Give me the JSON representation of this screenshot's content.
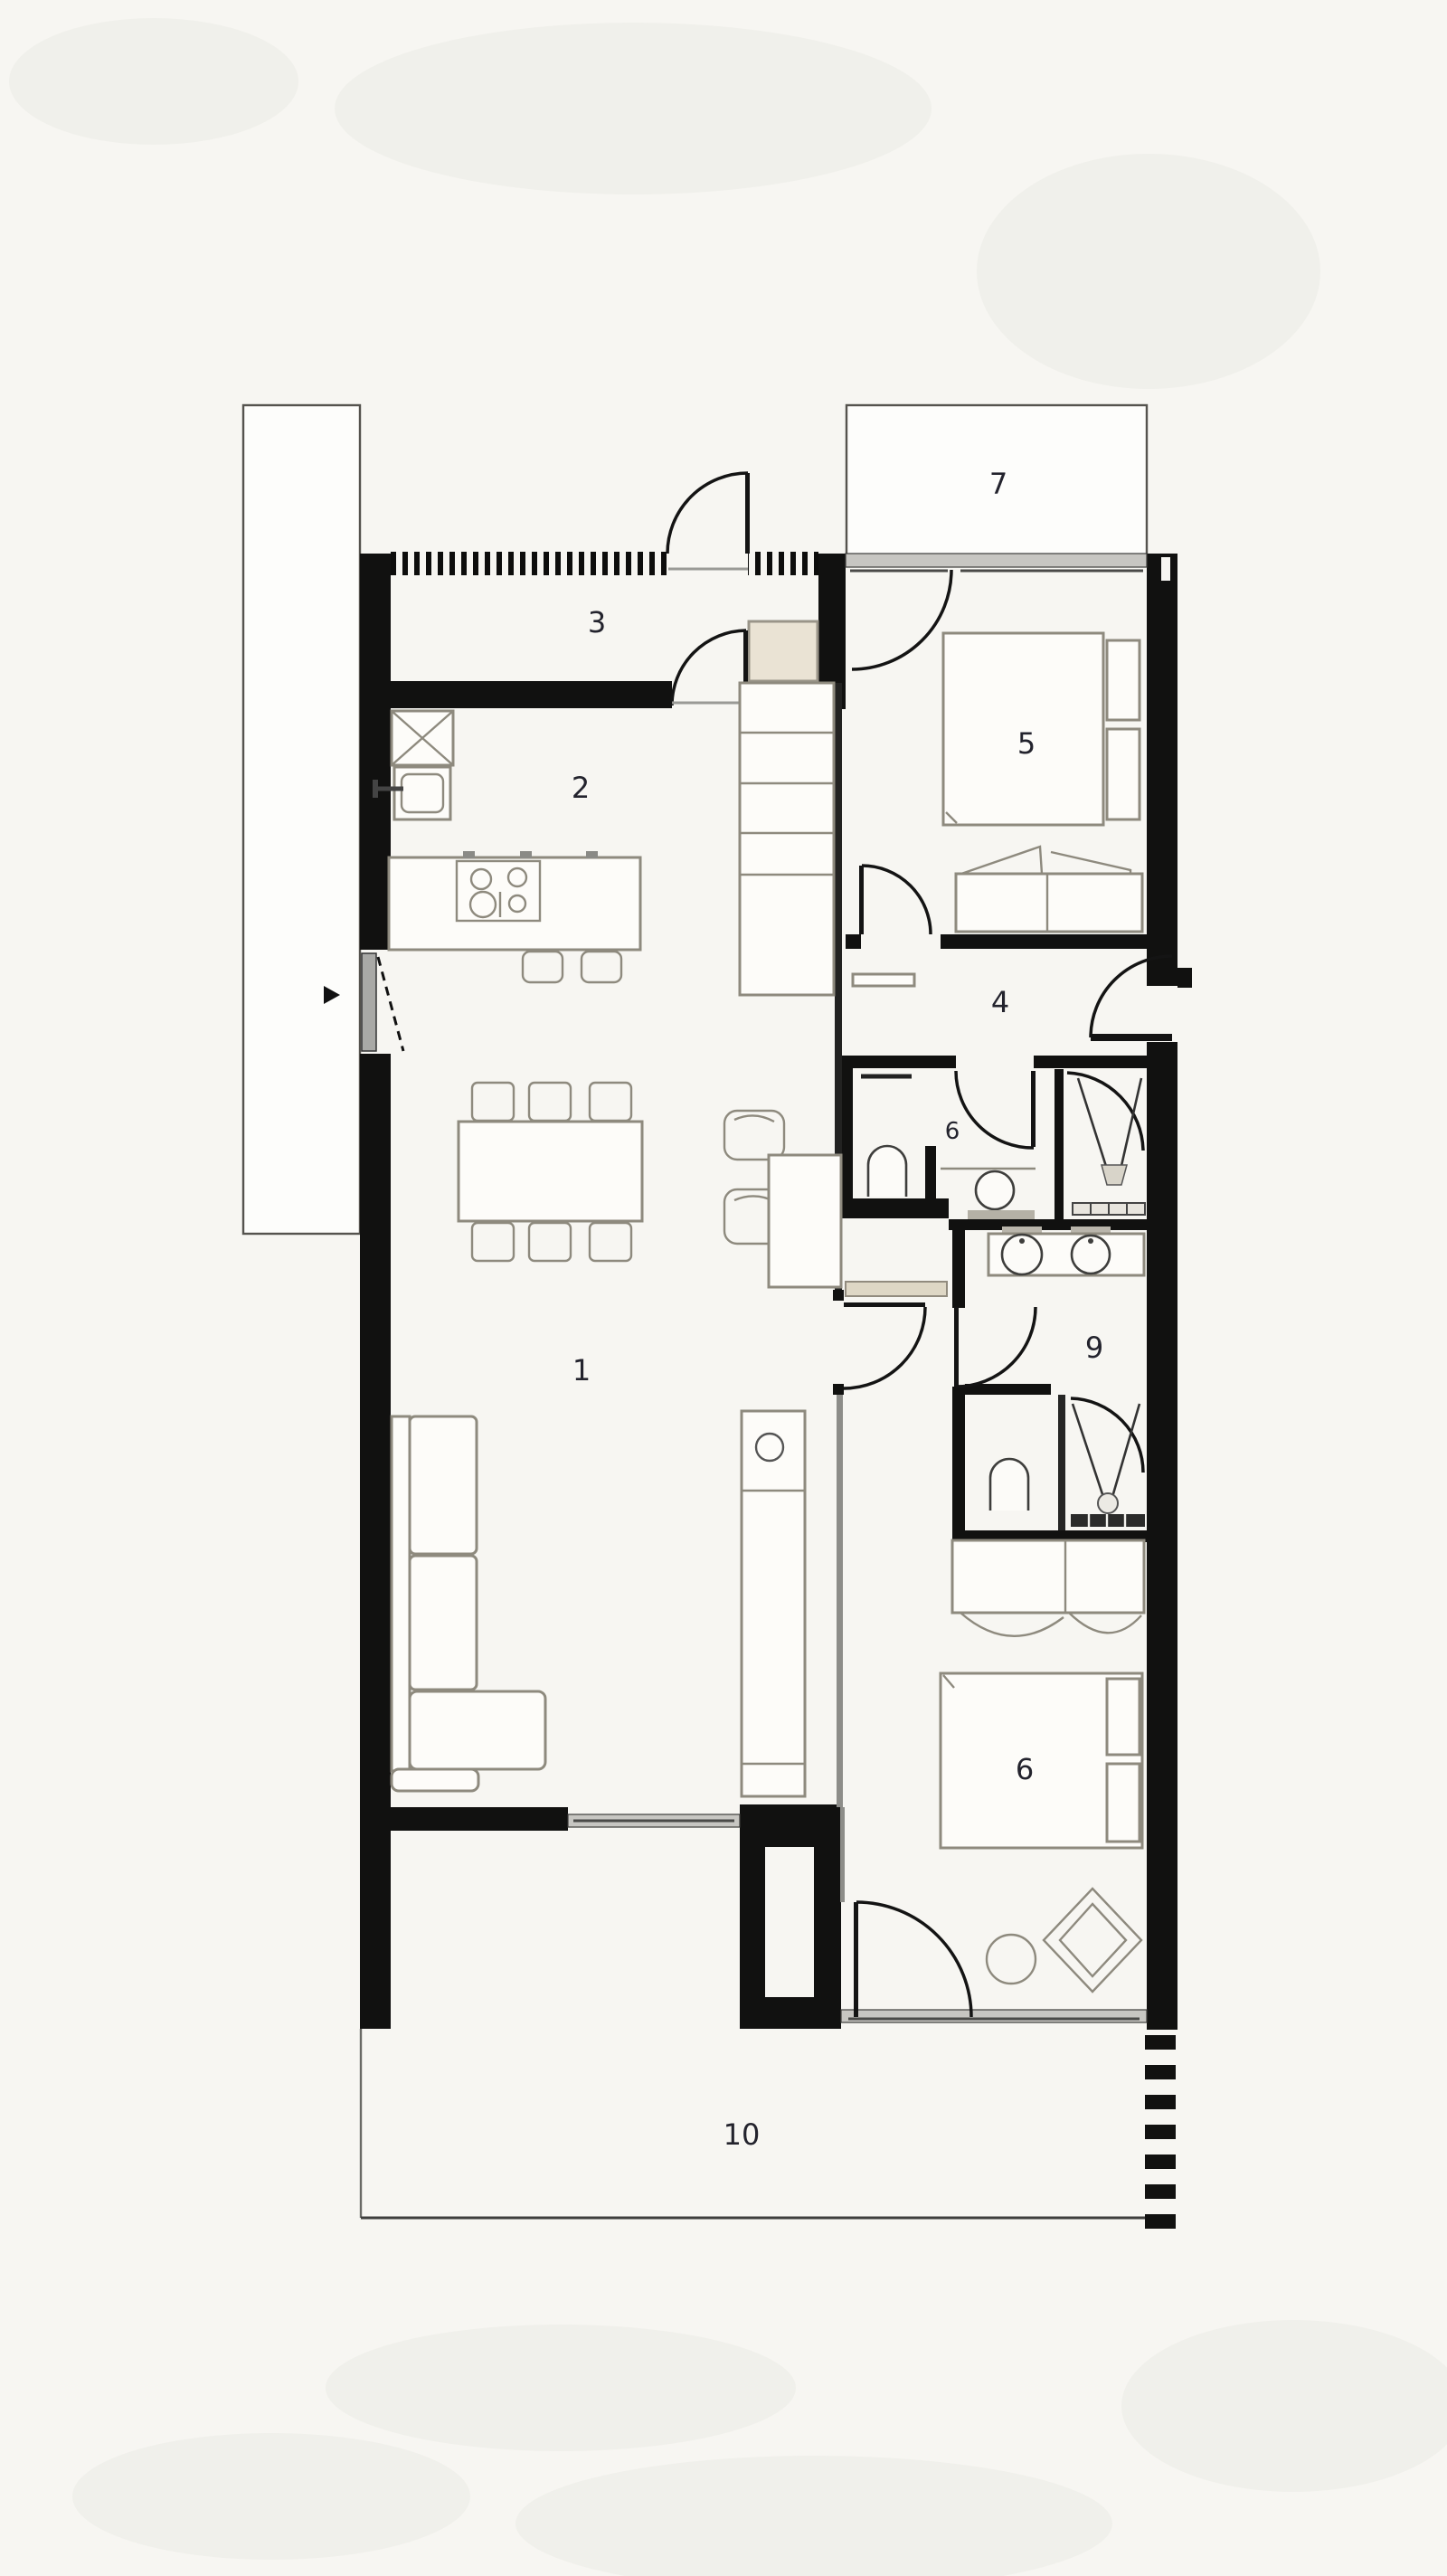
{
  "plan": {
    "title": "apartment-floor-plan",
    "rooms": [
      {
        "name": "living-room",
        "label": "1"
      },
      {
        "name": "kitchen",
        "label": "2"
      },
      {
        "name": "entry-hall",
        "label": "3"
      },
      {
        "name": "hallway",
        "label": "4"
      },
      {
        "name": "bedroom-upper",
        "label": "5"
      },
      {
        "name": "bathroom",
        "label": "6"
      },
      {
        "name": "terrace-upper",
        "label": "7"
      },
      {
        "name": "dressing-ensuite",
        "label": "9"
      },
      {
        "name": "bedroom-lower",
        "label": "6"
      },
      {
        "name": "terrace-lower",
        "label": "10"
      }
    ],
    "colors": {
      "paper": "#f7f6f2",
      "wall": "#111110",
      "furniture_stroke": "#8e8a7e",
      "glass": "#c7c6c2",
      "closet_fill": "#eae3d4",
      "label_ink": "#23232d"
    }
  }
}
